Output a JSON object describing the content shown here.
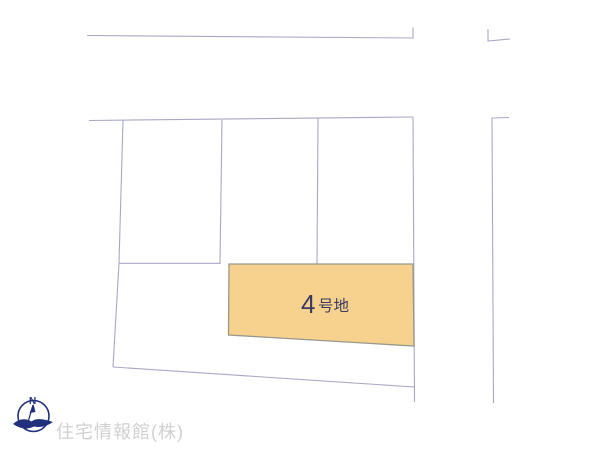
{
  "map": {
    "parcel": {
      "number": "4",
      "suffix": "号地",
      "label": "4号地",
      "fill_color": "#f7d28e",
      "border_color": "#98988c",
      "label_color": "#3a3a64"
    },
    "line_color": "#a8a8c6",
    "compass": {
      "north_label": "N",
      "color": "#20307c"
    },
    "watermark": {
      "text": "住宅情報館(株)",
      "color": "#d0d0d0"
    }
  }
}
